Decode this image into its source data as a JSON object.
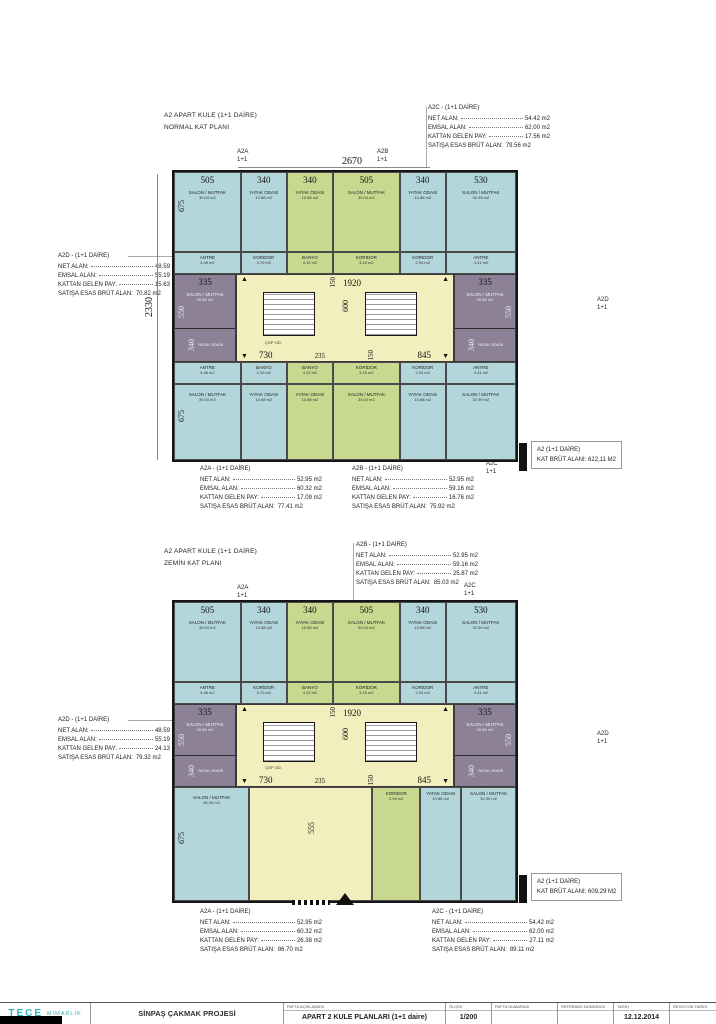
{
  "rooms": {
    "salon_corner": {
      "name": "SALON / MUTFAK",
      "area": "30.04 m2"
    },
    "salon_corner_lg": {
      "name": "SALON / MUTFAK",
      "area": "32.99 m2"
    },
    "salon_side": {
      "name": "SALON / MUTFAK",
      "area": "20.86 m2"
    },
    "yatak": {
      "name": "YATAK ODASI",
      "area": "10.88 m2"
    },
    "yatak_side": {
      "name": "YATAK ODASI",
      "area": "12.00 m2"
    },
    "banyo": {
      "name": "BANYO",
      "area": "4.10 m2"
    },
    "koridor": {
      "name": "KORİDOR",
      "area": "3.70 m2"
    },
    "koridor_g": {
      "name": "KORİDOR",
      "area": "3.15 m2"
    },
    "koridor_sm": {
      "name": "KORİDOR",
      "area": "2.94 m2"
    },
    "antre": {
      "name": "ANTRE",
      "area": "4.48 m2"
    },
    "antre_sm": {
      "name": "ANTRE",
      "area": "4.41 m2"
    },
    "cop": "ÇÖP OD."
  },
  "plan1": {
    "title_line1": "A2 APART KULE (1+1 DAİRE)",
    "title_line2": "NORMAL KAT PLANI",
    "units": {
      "a2a": "A2A",
      "a2b": "A2B",
      "a2c": "A2C",
      "a2d": "A2D",
      "type": "1+1"
    },
    "dims": {
      "overall_top": "2670",
      "overall_left": "2330",
      "top": [
        "505",
        "340",
        "340",
        "505",
        "340",
        "530"
      ],
      "corner_side": "675",
      "wing_top": "335",
      "wing_side": "550",
      "wing_yatak": "340",
      "core_top": "1920",
      "core_s": "150",
      "core_mid": "600",
      "core_b1": "730",
      "core_b2": "235",
      "core_b3": "845"
    },
    "ann_a2c": {
      "title": "A2C - (1+1 DAİRE)",
      "rows": [
        [
          "NET ALAN:",
          "54.42 m2"
        ],
        [
          "EMSAL ALAN:",
          "62.00 m2"
        ],
        [
          "KATTAN GELEN PAY:",
          "17.56 m2"
        ],
        [
          "SATIŞA ESAS BRÜT ALAN:",
          "79.56 m2"
        ]
      ]
    },
    "ann_a2d": {
      "title": "A2D - (1+1 DAİRE)",
      "rows": [
        [
          "NET ALAN:",
          "48.59 m2"
        ],
        [
          "EMSAL ALAN:",
          "55.19 m2"
        ],
        [
          "KATTAN GELEN PAY:",
          "15.63 m2"
        ],
        [
          "SATIŞA ESAS BRÜT ALAN:",
          "70.82 m2"
        ]
      ]
    },
    "ann_a2a": {
      "title": "A2A - (1+1 DAİRE)",
      "rows": [
        [
          "NET ALAN:",
          "52.95 m2"
        ],
        [
          "EMSAL ALAN:",
          "60.32 m2"
        ],
        [
          "KATTAN GELEN PAY:",
          "17.09 m2"
        ],
        [
          "SATIŞA ESAS BRÜT ALAN:",
          "77.41 m2"
        ]
      ]
    },
    "ann_a2b": {
      "title": "A2B - (1+1 DAİRE)",
      "rows": [
        [
          "NET ALAN:",
          "52.95 m2"
        ],
        [
          "EMSAL ALAN:",
          "59.16 m2"
        ],
        [
          "KATTAN GELEN PAY:",
          "16.76 m2"
        ],
        [
          "SATIŞA ESAS BRÜT ALAN:",
          "75.92 m2"
        ]
      ]
    },
    "summary": {
      "line1": "A2 (1+1 DAİRE)",
      "line2": "KAT BRÜT ALANI: 622,11 M2"
    }
  },
  "plan2": {
    "title_line1": "A2 APART KULE (1+1 DAİRE)",
    "title_line2": "ZEMİN KAT PLANI",
    "units": {
      "a2a": "A2A",
      "a2b": "A2B",
      "a2c": "A2C",
      "a2d": "A2D",
      "type": "1+1"
    },
    "dims": {
      "top": [
        "505",
        "340",
        "340",
        "505",
        "340",
        "530"
      ],
      "corner_side": "675",
      "wing_top": "335",
      "wing_side": "550",
      "wing_yatak": "340",
      "core_top": "1920",
      "core_s": "150",
      "core_mid": "600",
      "core_b1": "730",
      "core_b2": "235",
      "core_b3": "845",
      "lobby": "555"
    },
    "ann_a2b": {
      "title": "A2B - (1+1 DAİRE)",
      "rows": [
        [
          "NET ALAN:",
          "52.95 m2"
        ],
        [
          "EMSAL ALAN:",
          "59.16 m2"
        ],
        [
          "KATTAN GELEN PAY:",
          "25.87 m2"
        ],
        [
          "SATIŞA ESAS BRÜT ALAN:",
          "85.03 m2"
        ]
      ]
    },
    "ann_a2d": {
      "title": "A2D - (1+1 DAİRE)",
      "rows": [
        [
          "NET ALAN:",
          "48.59 m2"
        ],
        [
          "EMSAL ALAN:",
          "55.19 m2"
        ],
        [
          "KATTAN GELEN PAY:",
          "24.13 m2"
        ],
        [
          "SATIŞA ESAS BRÜT ALAN:",
          "79.32 m2"
        ]
      ]
    },
    "ann_a2a": {
      "title": "A2A - (1+1 DAİRE)",
      "rows": [
        [
          "NET ALAN:",
          "52.95 m2"
        ],
        [
          "EMSAL ALAN:",
          "60.32 m2"
        ],
        [
          "KATTAN GELEN PAY:",
          "26.38 m2"
        ],
        [
          "SATIŞA ESAS BRÜT ALAN:",
          "86.70 m2"
        ]
      ]
    },
    "ann_a2c": {
      "title": "A2C - (1+1 DAİRE)",
      "rows": [
        [
          "NET ALAN:",
          "54.42 m2"
        ],
        [
          "EMSAL ALAN:",
          "62.00 m2"
        ],
        [
          "KATTAN GELEN PAY:",
          "27.11 m2"
        ],
        [
          "SATIŞA ESAS BRÜT ALAN:",
          "89.11 m2"
        ]
      ]
    },
    "summary": {
      "line1": "A2 (1+1 DAİRE)",
      "line2": "KAT BRÜT ALANI: 609,29 M2"
    }
  },
  "titleblock": {
    "logo_main": "TECE",
    "logo_sub": "MİMARLIK",
    "project": "SİNPAŞ ÇAKMAK PROJESİ",
    "cols": [
      {
        "label": "PAFTA AÇIKLAMASI",
        "value": "APART 2  KULE PLANLARI (1+1 daire)"
      },
      {
        "label": "ÖLÇEK",
        "value": "1/200"
      },
      {
        "label": "PAFTA NUMARASI",
        "value": ""
      },
      {
        "label": "REFERANS NUMARASI",
        "value": ""
      },
      {
        "label": "TARİH",
        "value": "12.12.2014"
      },
      {
        "label": "REVİZYON TARİHİ",
        "value": ""
      }
    ]
  }
}
